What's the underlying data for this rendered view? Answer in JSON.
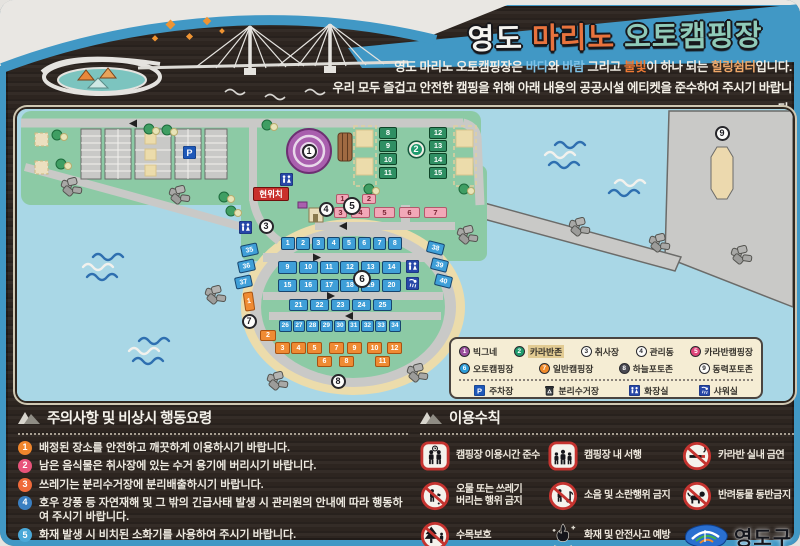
{
  "title": {
    "part1": "영도",
    "part2": "마리노",
    "part3": "오토캠핑장"
  },
  "intro": {
    "line1_segments": [
      {
        "t": "영도 마리노 오토캠핑장은 ",
        "c": "w"
      },
      {
        "t": "바다",
        "c": "b"
      },
      {
        "t": "와 ",
        "c": "w"
      },
      {
        "t": "바람",
        "c": "b"
      },
      {
        "t": " 그리고 ",
        "c": "w"
      },
      {
        "t": "불빛",
        "c": "o"
      },
      {
        "t": "이 하나 되는 ",
        "c": "w"
      },
      {
        "t": "힐링쉼터",
        "c": "t"
      },
      {
        "t": "입니다.",
        "c": "w"
      }
    ],
    "line2": "우리 모두 즐겁고 안전한 캠핑을 위해 아래 내용의 공공시설 에티켓을 준수하여 주시기 바랍니다."
  },
  "map": {
    "current_location": "현위치",
    "badges": [
      "1",
      "2",
      "3",
      "4",
      "5",
      "6",
      "7",
      "8",
      "9"
    ],
    "units": {
      "auto_row1": [
        "1",
        "2",
        "3",
        "4",
        "5",
        "6",
        "7",
        "8"
      ],
      "auto_row2": [
        "9",
        "10",
        "11",
        "12",
        "13",
        "14"
      ],
      "auto_row3": [
        "15",
        "16",
        "17",
        "18",
        "19",
        "20"
      ],
      "auto_row4": [
        "21",
        "22",
        "23",
        "24",
        "25"
      ],
      "auto_row5": [
        "26",
        "27",
        "28",
        "29",
        "30",
        "31",
        "32",
        "33",
        "34"
      ],
      "side_left": [
        "35",
        "36",
        "37"
      ],
      "side_right": [
        "38",
        "39",
        "40"
      ],
      "caravan_left": [
        "8",
        "9",
        "10",
        "11"
      ],
      "caravan_right": [
        "12",
        "13",
        "14",
        "15"
      ],
      "caravan_camp_row1": [
        "1",
        "2"
      ],
      "caravan_camp_row2": [
        "3",
        "4",
        "5",
        "6",
        "7"
      ],
      "general_side": [
        "1",
        "2"
      ],
      "general_rowA": [
        "3",
        "4",
        "5",
        "7",
        "9",
        "10",
        "12"
      ],
      "general_rowB": [
        "6",
        "8",
        "11"
      ]
    },
    "parking_label": "P"
  },
  "legend": {
    "rows": [
      [
        {
          "n": "1",
          "label": "빅그네",
          "color": "#9b4f9e",
          "fg": "#fff",
          "highlight": false
        },
        {
          "n": "2",
          "label": "카라반존",
          "color": "#1f9b6e",
          "fg": "#fff",
          "highlight": true
        },
        {
          "n": "3",
          "label": "취사장",
          "color": "#fdfdfb",
          "fg": "#2a2a2e",
          "highlight": false
        },
        {
          "n": "4",
          "label": "관리동",
          "color": "#fdfdfb",
          "fg": "#2a2a2e",
          "highlight": false
        },
        {
          "n": "5",
          "label": "카라반캠핑장",
          "color": "#e0457b",
          "fg": "#fff",
          "highlight": false
        }
      ],
      [
        {
          "n": "6",
          "label": "오토캠핑장",
          "color": "#2b9cd8",
          "fg": "#fff",
          "highlight": false
        },
        {
          "n": "7",
          "label": "일반캠핑장",
          "color": "#f08a2a",
          "fg": "#fff",
          "highlight": false
        },
        {
          "n": "8",
          "label": "하늘포토존",
          "color": "#4a4a52",
          "fg": "#fff",
          "highlight": false
        },
        {
          "n": "9",
          "label": "동력포토존",
          "color": "#fdfdfb",
          "fg": "#2a2a2e",
          "highlight": false
        }
      ]
    ],
    "facilities": [
      {
        "icon": "parking",
        "label": "주차장"
      },
      {
        "icon": "bin",
        "label": "분리수거장"
      },
      {
        "icon": "wc",
        "label": "화장실"
      },
      {
        "icon": "shower",
        "label": "샤워실"
      }
    ]
  },
  "notice": {
    "title": "주의사항 및 비상시 행동요령",
    "items": [
      {
        "n": "1",
        "color": "#f0862c",
        "text": "배정된 장소를 안전하고 깨끗하게 이용하시기 바랍니다."
      },
      {
        "n": "2",
        "color": "#e8537a",
        "text": "남은 음식물은 취사장에 있는 수거 용기에 버리시기 바랍니다."
      },
      {
        "n": "3",
        "color": "#ef6a3a",
        "text": "쓰레기는 분리수거장에 분리배출하시기 바랍니다."
      },
      {
        "n": "4",
        "color": "#3a7fc1",
        "text": "호우 강풍 등 자연재해 및 그 밖의 긴급사태 발생 시 관리원의 안내에 따라 행동하여 주시기 바랍니다."
      },
      {
        "n": "5",
        "color": "#4aa8d8",
        "text": "화재 발생 시 비치된 소화기를 사용하여 주시기 바랍니다."
      }
    ]
  },
  "rules": {
    "title": "이용수칙",
    "items": [
      {
        "icon": "time",
        "label": "캠핑장 이용시간 준수"
      },
      {
        "icon": "slow",
        "label": "캠핑장 내 서행"
      },
      {
        "icon": "nosmoke",
        "label": "카라반 실내 금연"
      },
      {
        "icon": "nolitter",
        "label": "오물 또는 쓰레기\n버리는 행위 금지"
      },
      {
        "icon": "nonoise",
        "label": "소음 및 소란행위 금지"
      },
      {
        "icon": "nopets",
        "label": "반려동물 동반금지"
      },
      {
        "icon": "tree",
        "label": "수목보호"
      },
      {
        "icon": "fire",
        "label": "화재 및 안전사고 예방"
      }
    ],
    "logo": "영도구"
  },
  "palette": {
    "frame_blue": "#4198c5",
    "wood": "#2f2722",
    "water": "#a9d7e6",
    "land_green": "#8ccaa5",
    "sand": "#ecdcab",
    "road": "#c9c9c7",
    "unit_blue": "#3f9fd8",
    "unit_green": "#2f8f63",
    "unit_pink": "#f2a8b8",
    "unit_orange": "#ef8b33",
    "legend_bg": "#f5edd4",
    "current_loc_red": "#c9302c",
    "title_orange": "#e8733d",
    "title_mint": "#8fcab8"
  }
}
